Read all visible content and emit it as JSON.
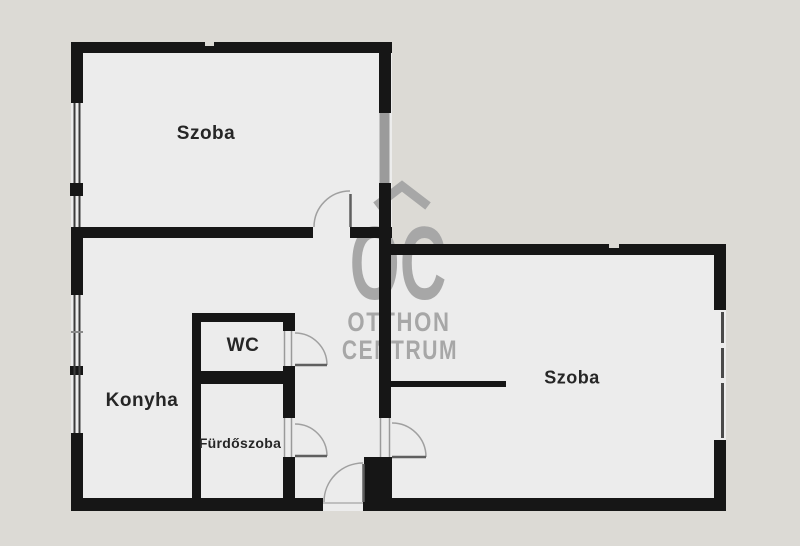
{
  "plan": {
    "rooms": [
      {
        "id": "room-top-left",
        "label": "Szoba"
      },
      {
        "id": "kitchen",
        "label": "Konyha"
      },
      {
        "id": "wc",
        "label": "WC"
      },
      {
        "id": "bathroom",
        "label": "Fürdőszoba"
      },
      {
        "id": "room-right",
        "label": "Szoba"
      }
    ],
    "watermark": {
      "logo_text": "OC",
      "line1": "OTTHON",
      "line2": "CENTRUM"
    },
    "colors": {
      "background": "#dcdad5",
      "floor": "#ececec",
      "wall": "#161616",
      "watermark": "#a7a7a7",
      "window_line": "#3c3c3c",
      "door_arc": "#a0a0a0"
    }
  }
}
